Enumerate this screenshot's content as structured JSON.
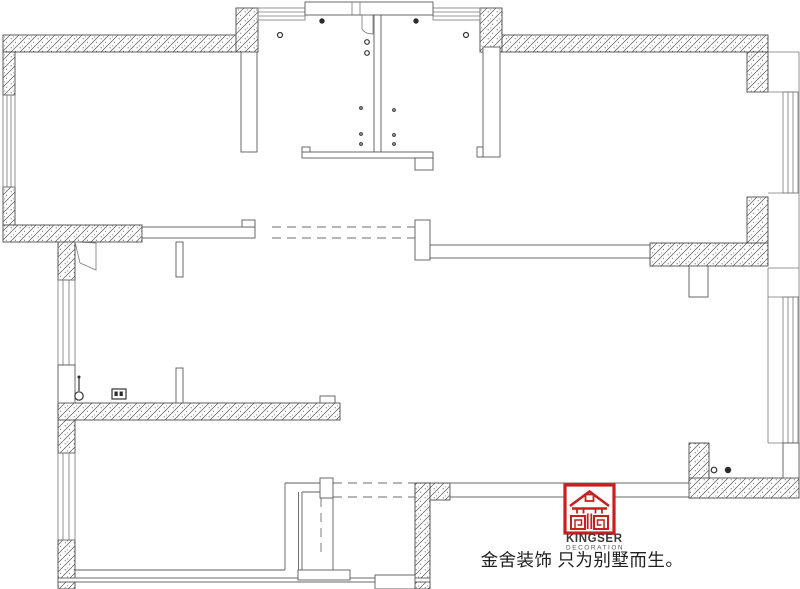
{
  "page": {
    "background": "#ffffff",
    "width": 800,
    "height": 589,
    "kind": "apartment floor plan drawing"
  },
  "floor_plan": {
    "line_color": "#4a4a4a",
    "hatch_line_color": "#555555",
    "thin_line_color": "#6f6f6f",
    "dash_color": "#6e6e6e",
    "symbol_color": "#333333",
    "elements": [
      "exterior-hatched-walls",
      "interior-partition-walls",
      "window-strips",
      "bay-windows",
      "entry-core-with-double-doors",
      "door-swing-leaves",
      "dashed-wall-openings",
      "staircase",
      "columns",
      "drain-and-fixture-symbols"
    ]
  },
  "brand": {
    "name": "KINGSER",
    "subtitle": "DECORATION",
    "slogan": "金舍装饰 只为别墅而生。",
    "logo_icon": "kingser-house-seal-icon",
    "logo_color": "#c4211f",
    "name_color": "#3a3a3a",
    "subtitle_color": "#555555",
    "slogan_color": "#1f1f1f"
  }
}
